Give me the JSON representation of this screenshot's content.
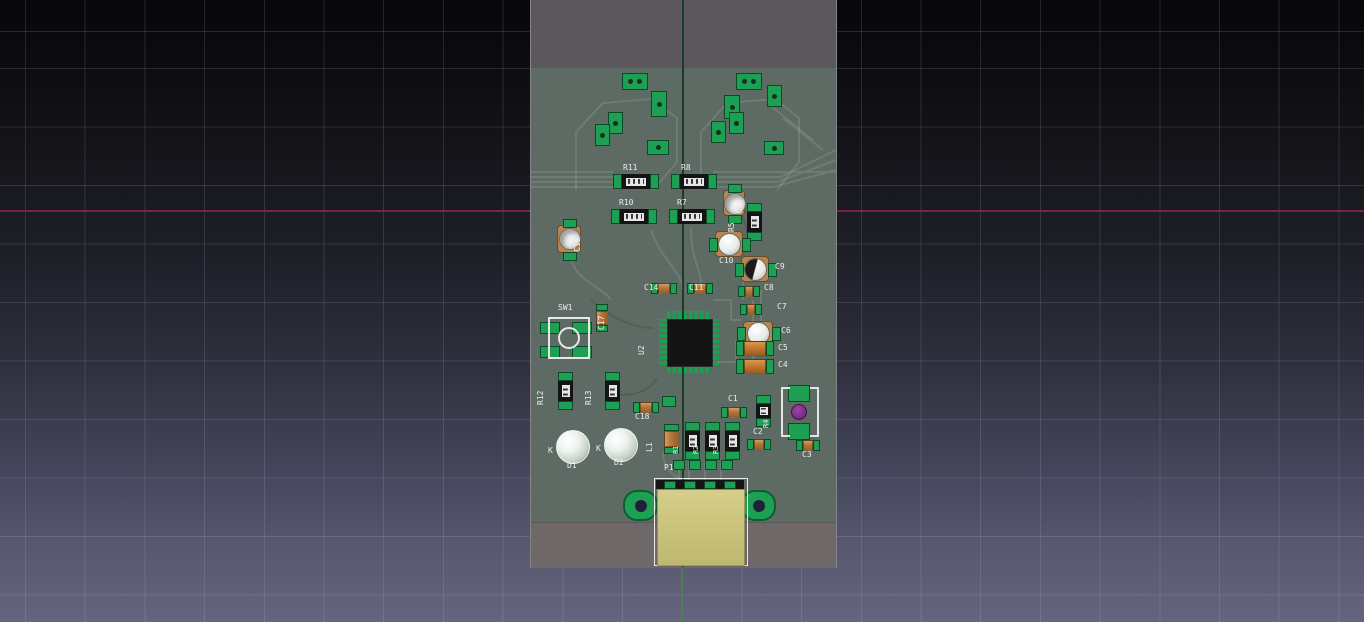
{
  "viewport": {
    "kind": "3d-pcb-view",
    "axes": {
      "x_axis_color": "#7a2340",
      "y_axis_color": "#4e7e54"
    }
  },
  "board": {
    "colors": {
      "pcb": "#5e6b64",
      "top_margin_zone": "#5c575c",
      "bottom_margin_zone": "#6e6868",
      "pad_green": "#1da053",
      "silkscreen": "#ededed",
      "ic_body": "#141414",
      "electrolytic_base": "#b9854e",
      "tantalum_orange": "#c0762f",
      "usb_body_yellow": "#cbc57d",
      "led_dome_silver": "#dfe6e1",
      "violet_part": "#7d2f8a"
    },
    "silkscreen_labels": {
      "r1": "R1",
      "r2": "R2",
      "r3": "R3",
      "r4": "R4",
      "r5": "R5",
      "r7": "R7",
      "r8": "R8",
      "r10": "R10",
      "r11": "R11",
      "r12": "R12",
      "r13": "R13",
      "c1": "C1",
      "c2": "C2",
      "c3": "C3",
      "c4": "C4",
      "c5": "C5",
      "c6": "C6",
      "c7": "C7",
      "c8": "C8",
      "c9": "C9",
      "c10": "C10",
      "c11": "C11",
      "c13": "C13",
      "c14": "C14",
      "c16": "C16",
      "c17": "C17",
      "c18": "C18",
      "l1": "L1",
      "u2": "U2",
      "sw1": "SW1",
      "p1": "P1",
      "d1": "D1",
      "d2": "D2",
      "d1_cathode": "K",
      "d2_cathode": "K"
    }
  }
}
